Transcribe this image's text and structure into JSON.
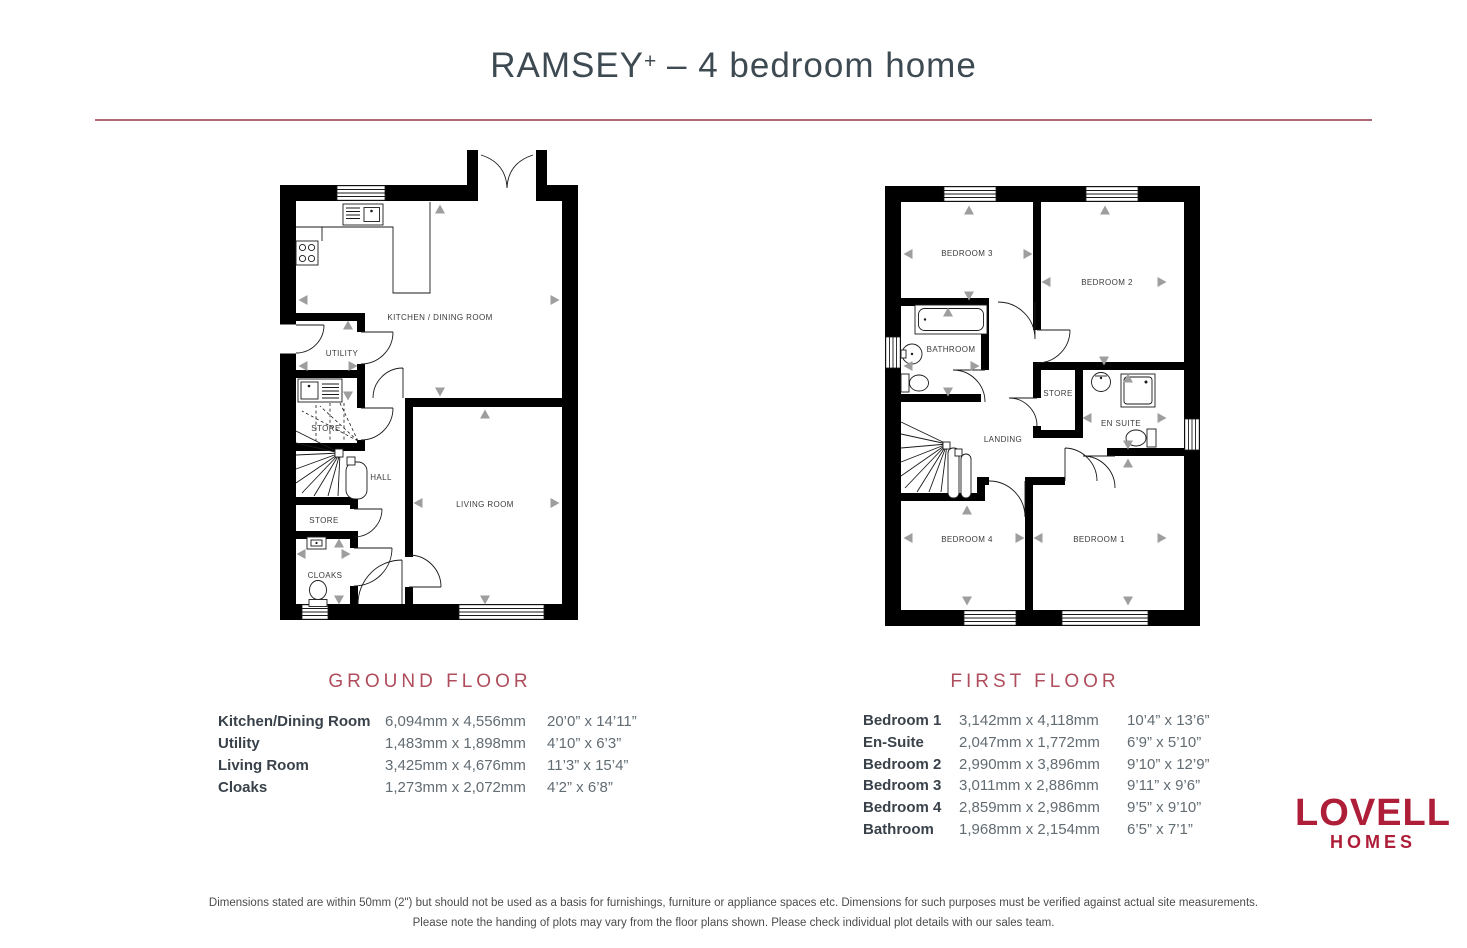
{
  "header": {
    "title_name": "RAMSEY",
    "title_plus": "+",
    "title_suffix": " – 4 bedroom home"
  },
  "ground": {
    "heading": "GROUND FLOOR",
    "rooms": {
      "kitchen": "KITCHEN / DINING ROOM",
      "utility": "UTILITY",
      "store_upper": "STORE",
      "hall": "HALL",
      "store_lower": "STORE",
      "cloaks": "CLOAKS",
      "living": "LIVING ROOM"
    },
    "table": [
      {
        "name": "Kitchen/Dining Room",
        "metric": "6,094mm x 4,556mm",
        "imperial": "20’0” x 14’11”"
      },
      {
        "name": "Utility",
        "metric": "1,483mm x 1,898mm",
        "imperial": "4’10” x 6’3”"
      },
      {
        "name": "Living Room",
        "metric": "3,425mm x 4,676mm",
        "imperial": "11’3” x 15’4”"
      },
      {
        "name": "Cloaks",
        "metric": "1,273mm x 2,072mm",
        "imperial": "4’2” x 6’8”"
      }
    ]
  },
  "first": {
    "heading": "FIRST FLOOR",
    "rooms": {
      "bedroom3": "BEDROOM 3",
      "bedroom2": "BEDROOM 2",
      "bathroom": "BATHROOM",
      "store": "STORE",
      "landing": "LANDING",
      "ensuite": "EN SUITE",
      "bedroom4": "BEDROOM 4",
      "bedroom1": "BEDROOM 1"
    },
    "table": [
      {
        "name": "Bedroom 1",
        "metric": "3,142mm x 4,118mm",
        "imperial": "10’4” x 13’6”"
      },
      {
        "name": "En-Suite",
        "metric": "2,047mm x 1,772mm",
        "imperial": "6’9” x 5’10”"
      },
      {
        "name": "Bedroom 2",
        "metric": "2,990mm x 3,896mm",
        "imperial": "9’10” x 12’9”"
      },
      {
        "name": "Bedroom 3",
        "metric": "3,011mm x 2,886mm",
        "imperial": "9’11” x 9’6”"
      },
      {
        "name": "Bedroom 4",
        "metric": "2,859mm x 2,986mm",
        "imperial": "9’5” x 9’10”"
      },
      {
        "name": "Bathroom",
        "metric": "1,968mm x 2,154mm",
        "imperial": "6’5” x 7’1”"
      }
    ]
  },
  "logo": {
    "name": "LOVELL",
    "sub": "HOMES"
  },
  "footer": {
    "line1": "Dimensions stated are within 50mm (2\") but should not be used as a basis for furnishings, furniture or appliance spaces etc. Dimensions for such purposes must be verified against actual site measurements.",
    "line2": "Please note the handing of plots may vary from the floor plans shown. Please check individual plot details with our sales team."
  },
  "colors": {
    "heading_accent": "#b04d5c",
    "divider": "#b06a75",
    "title_text": "#3e4a52",
    "logo_red": "#ae1e38",
    "arrow_grey": "#9e9e9e",
    "wall": "#000000"
  }
}
